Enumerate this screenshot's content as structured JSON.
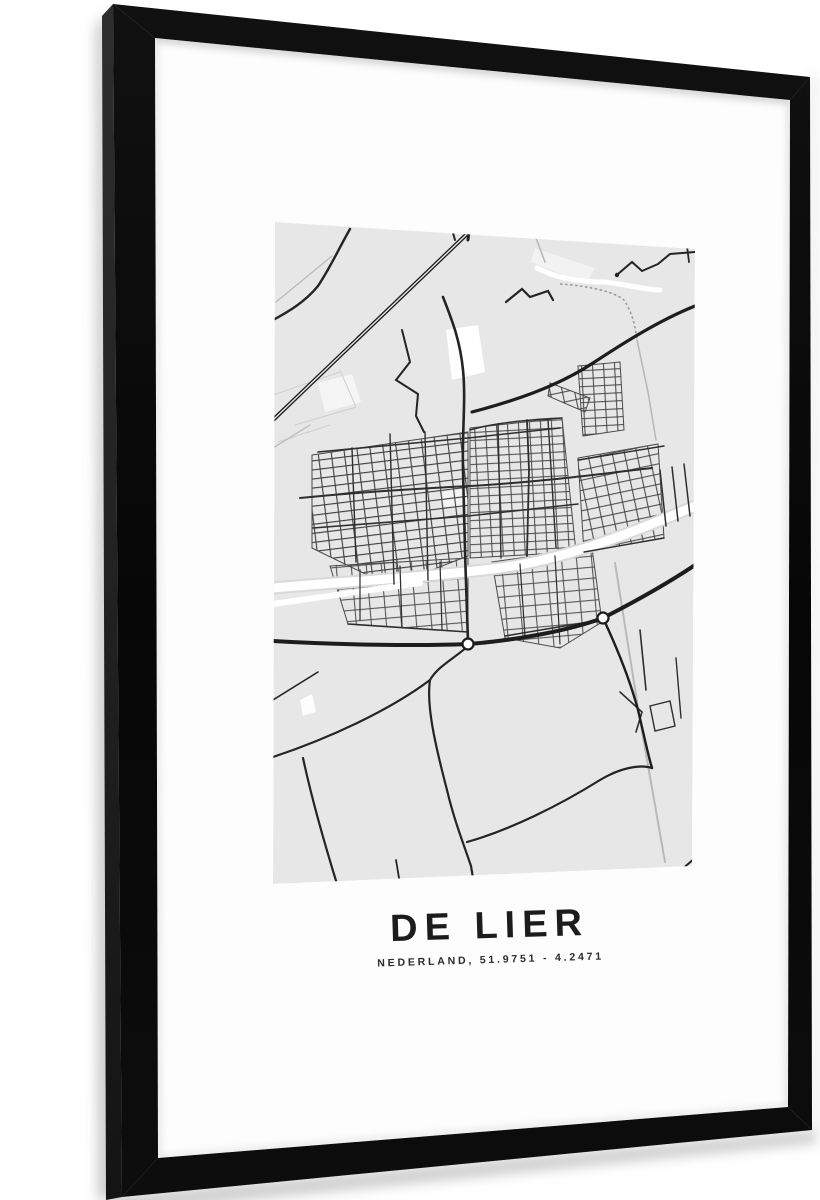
{
  "poster": {
    "title": "DE LIER",
    "subtitle": "NEDERLAND, 51.9751 - 4.2471"
  },
  "colors": {
    "page_background": "#ffffff",
    "frame_black": "#0a0a0a",
    "frame_side": "#232323",
    "mat_white": "#fdfdfd",
    "map_background": "#e7e7e7",
    "road_dark": "#242424",
    "road_medium": "#2e2e2e",
    "road_light_gray": "#b9b9b9",
    "highway_white": "#ffffff",
    "title_color": "#1c1c1c"
  }
}
